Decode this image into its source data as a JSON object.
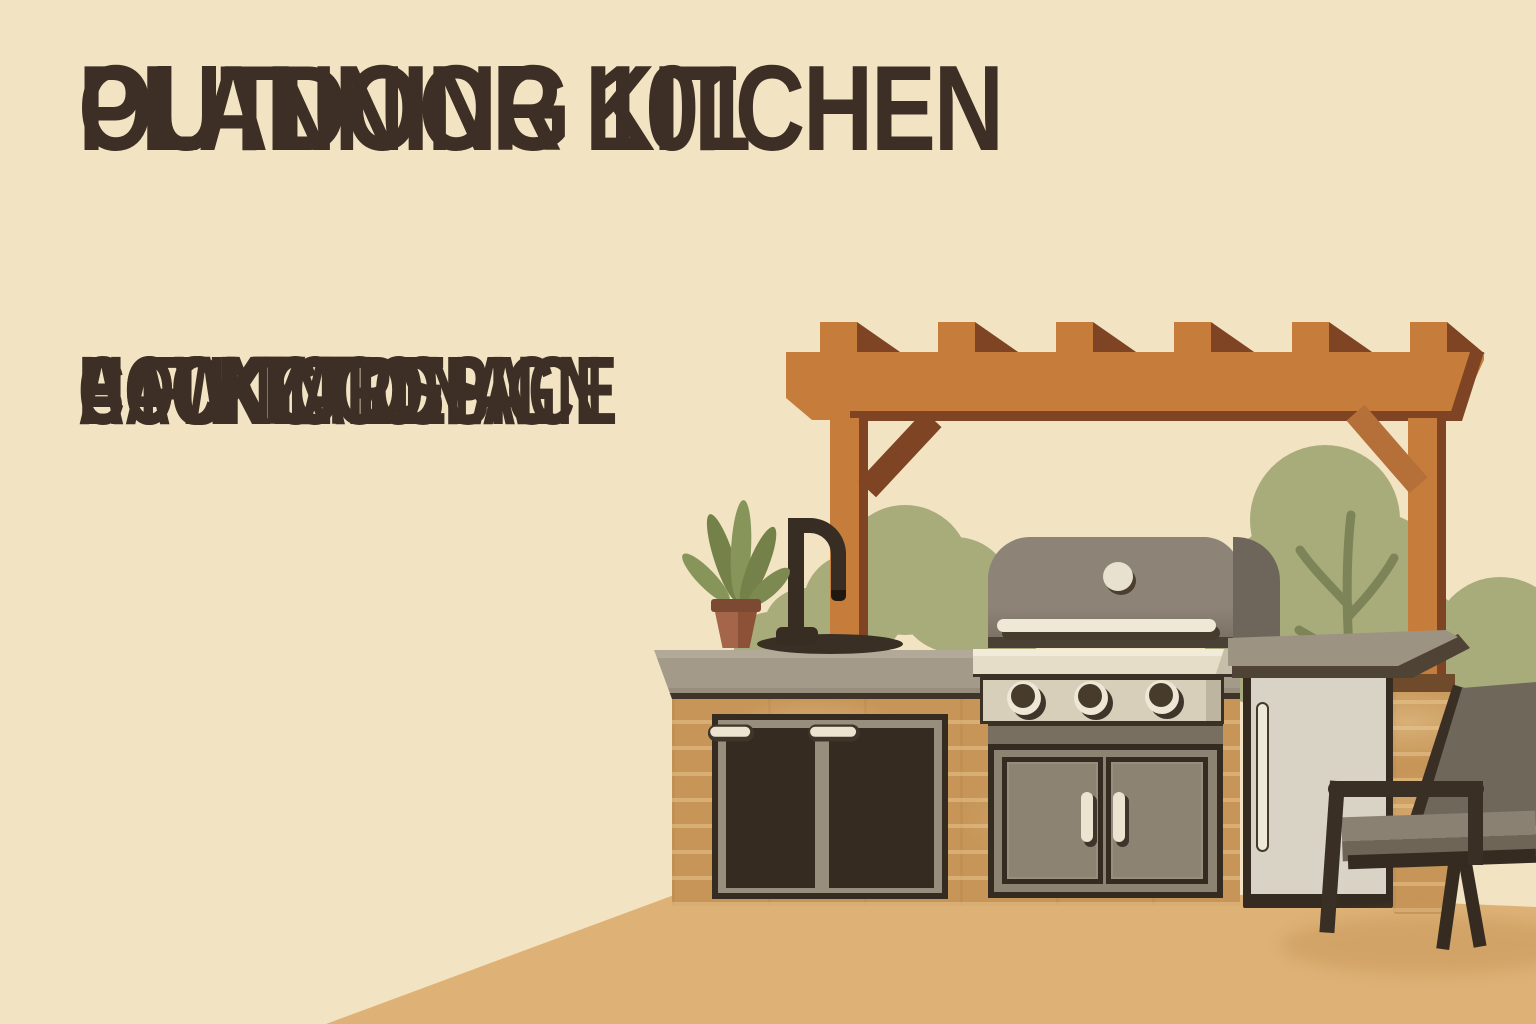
{
  "poster": {
    "title_lines": [
      "OUTDOOR KITCHEN",
      "PLANNING 101"
    ],
    "subtitle_lines": [
      "HOW TO DESIGN",
      "A FUNCTIONAL",
      "BACKYARD",
      "COOKING SPACE"
    ]
  },
  "illustration": {
    "scene": "Flat-style illustration of an outdoor kitchen island under a wood pergola",
    "elements": [
      "pergola with six rafters",
      "olive bushes with twigs",
      "potted plant",
      "black gooseneck faucet with sink",
      "gas grill with three knobs and double-door cabinet",
      "three-drawer cabinet",
      "two-drawer cabinet",
      "outdoor refrigerator",
      "brick island with stone countertop",
      "lounge chair",
      "tan patio ground"
    ]
  },
  "colors": {
    "bg": "#f2e4c3",
    "title": "#3e2f26",
    "pergola": "#c67c3b",
    "pergola-dark": "#7e4423",
    "brace-right": "#b5703a",
    "bush": "#a8ac7b",
    "twig": "#7d8457",
    "leaf": "#7c8a52",
    "leaf-light": "#8b995c",
    "pot": "#9a5b3e",
    "pot-rim": "#7c4a33",
    "counter-top": "#a39a89",
    "brick": "#c69557",
    "outline-dark": "#362b21",
    "cabinet": "#8c8372",
    "cabinet-frame": "#978e7d",
    "cream": "#ece4d1",
    "hood": "#8d8477",
    "hood-side": "#6e665a",
    "panel": "#d7cfba",
    "fridge-door": "#d9d3c6",
    "slab-top": "#9c9383",
    "slab-edge": "#4f4336",
    "chair-frame": "#3a2f24",
    "chair-cushion": "#6f6759",
    "seat-top": "#8a8172",
    "ground": "#deb277",
    "shadow": "#c8985a"
  }
}
